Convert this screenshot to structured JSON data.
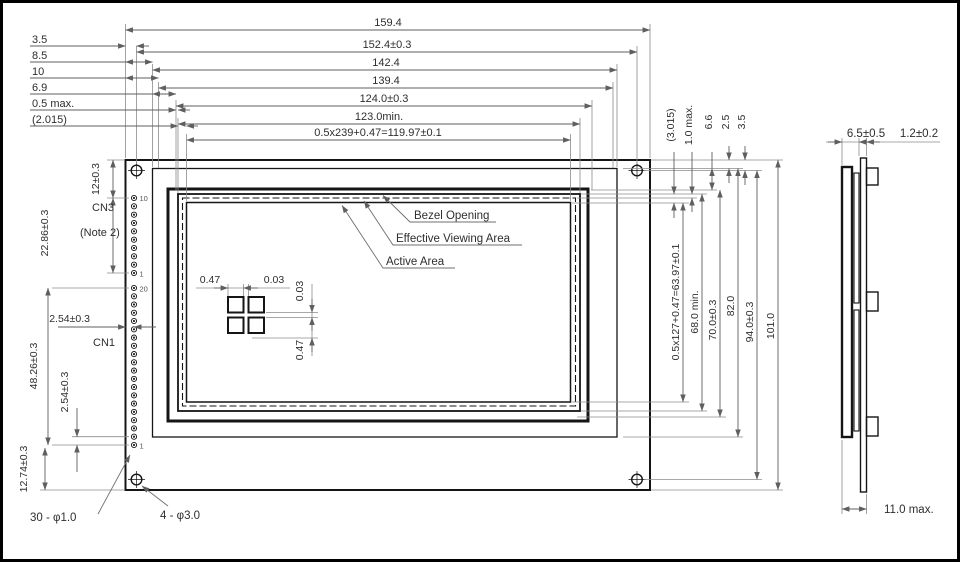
{
  "colors": {
    "background": "#ffffff",
    "frame_border": "#000000",
    "outline": "#151515",
    "dimension_line": "#5f5f5f",
    "text": "#2e2e2e"
  },
  "front_view": {
    "top_dims": [
      {
        "label": "159.4"
      },
      {
        "label": "152.4±0.3"
      },
      {
        "label": "142.4"
      },
      {
        "label": "139.4"
      },
      {
        "label": "124.0±0.3"
      },
      {
        "label": "123.0min."
      },
      {
        "label": "0.5x239+0.47=119.97±0.1"
      }
    ],
    "left_offset_dims": [
      {
        "label": "3.5"
      },
      {
        "label": "8.5"
      },
      {
        "label": "10"
      },
      {
        "label": "6.9"
      },
      {
        "label": "0.5 max."
      },
      {
        "label": "(2.015)"
      }
    ],
    "area_labels": [
      {
        "label": "Bezel Opening"
      },
      {
        "label": "Effective Viewing Area"
      },
      {
        "label": "Active Area"
      }
    ],
    "pixel_detail": {
      "h_pitch": "0.47",
      "h_gap": "0.03",
      "v_gap": "0.03",
      "v_pitch": "0.47"
    },
    "connectors": {
      "cn3_label": "CN3",
      "cn3_note": "(Note 2)",
      "cn1_label": "CN1",
      "cn3_pin_first": "10",
      "cn3_pin_last": "1",
      "cn1_pin_first": "20",
      "cn1_pin_last": "1",
      "cn3_offset_dim": "12±0.3",
      "cn3_span_dim": "22.86±0.3",
      "pin_x_offset_dim": "2.54±0.3",
      "cn1_span_dim": "48.26±0.3",
      "pin_pitch_dim": "2.54±0.3",
      "bottom_offset_dim": "12.74±0.3"
    },
    "hole_labels": {
      "pin_holes": "30 - φ1.0",
      "mount_holes": "4 - φ3.0"
    },
    "right_offset_dims": [
      {
        "label": "(3.015)"
      },
      {
        "label": "1.0 max."
      },
      {
        "label": "6.6"
      },
      {
        "label": "2.5"
      },
      {
        "label": "3.5"
      }
    ],
    "right_dims": [
      {
        "label": "0.5x127+0.47=63.97±0.1"
      },
      {
        "label": "68.0 min."
      },
      {
        "label": "70.0±0.3"
      },
      {
        "label": "82.0"
      },
      {
        "label": "94.0±0.3"
      },
      {
        "label": "101.0"
      }
    ]
  },
  "side_view": {
    "front_thickness_dim": "6.5±0.5",
    "pcb_thickness_dim": "1.2±0.2",
    "total_thickness_dim": "11.0 max."
  }
}
